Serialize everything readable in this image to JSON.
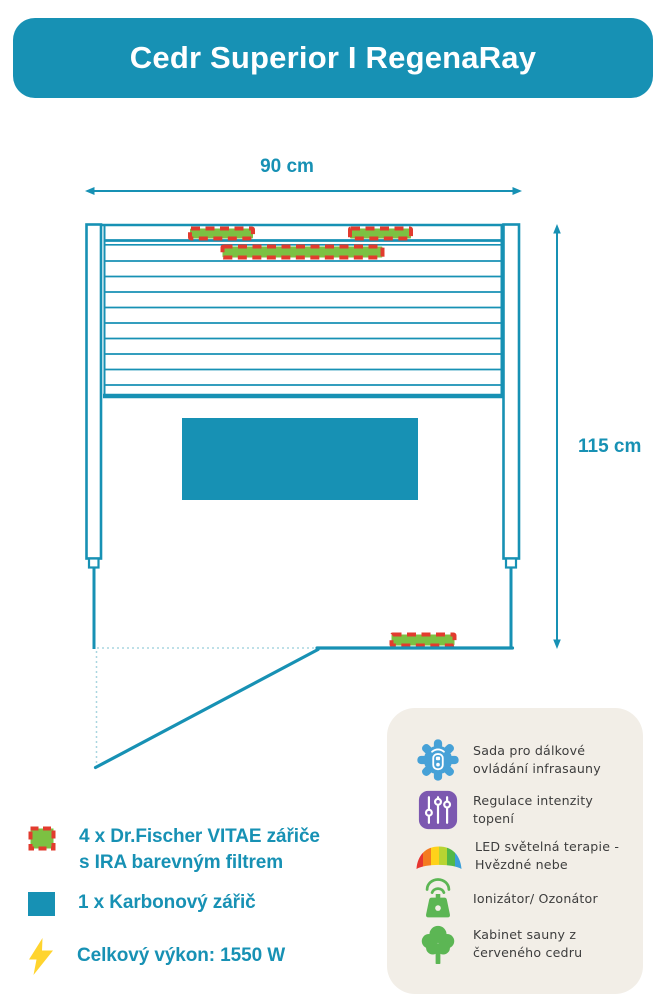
{
  "header": {
    "title": "Cedr Superior I RegenaRay"
  },
  "diagram": {
    "width_label": "90 cm",
    "height_label": "115 cm"
  },
  "legend": {
    "items": [
      {
        "icon": "vitae-heater-swatch",
        "label": "4 x Dr.Fischer VITAE zářiče s IRA barevným filtrem"
      },
      {
        "icon": "carbon-heater-swatch",
        "label": "1 x Karbonový zářič"
      },
      {
        "icon": "lightning-icon",
        "label": "Celkový výkon: 1550 W"
      }
    ]
  },
  "features": {
    "items": [
      {
        "icon": "remote-control-gear-icon",
        "label": "Sada pro dálkové ovládání infrasauny"
      },
      {
        "icon": "intensity-sliders-icon",
        "label": "Regulace intenzity topení"
      },
      {
        "icon": "rainbow-led-icon",
        "label": "LED světelná terapie - Hvězdné nebe"
      },
      {
        "icon": "ionizer-icon",
        "label": "Ionizátor/ Ozonátor"
      },
      {
        "icon": "cedar-tree-icon",
        "label": "Kabinet sauny z červeného cedru"
      }
    ]
  },
  "colors": {
    "teal": "#1791b4",
    "red": "#e23b2e",
    "green": "#7cc142",
    "yellow": "#ffd42e",
    "blue": "#46a1d7",
    "purple": "#7c58b0",
    "icon-green": "#5cb654",
    "panel-bg": "#f2eee7",
    "panel-text": "#3d3d3d",
    "dotted": "#a9d6e0"
  }
}
